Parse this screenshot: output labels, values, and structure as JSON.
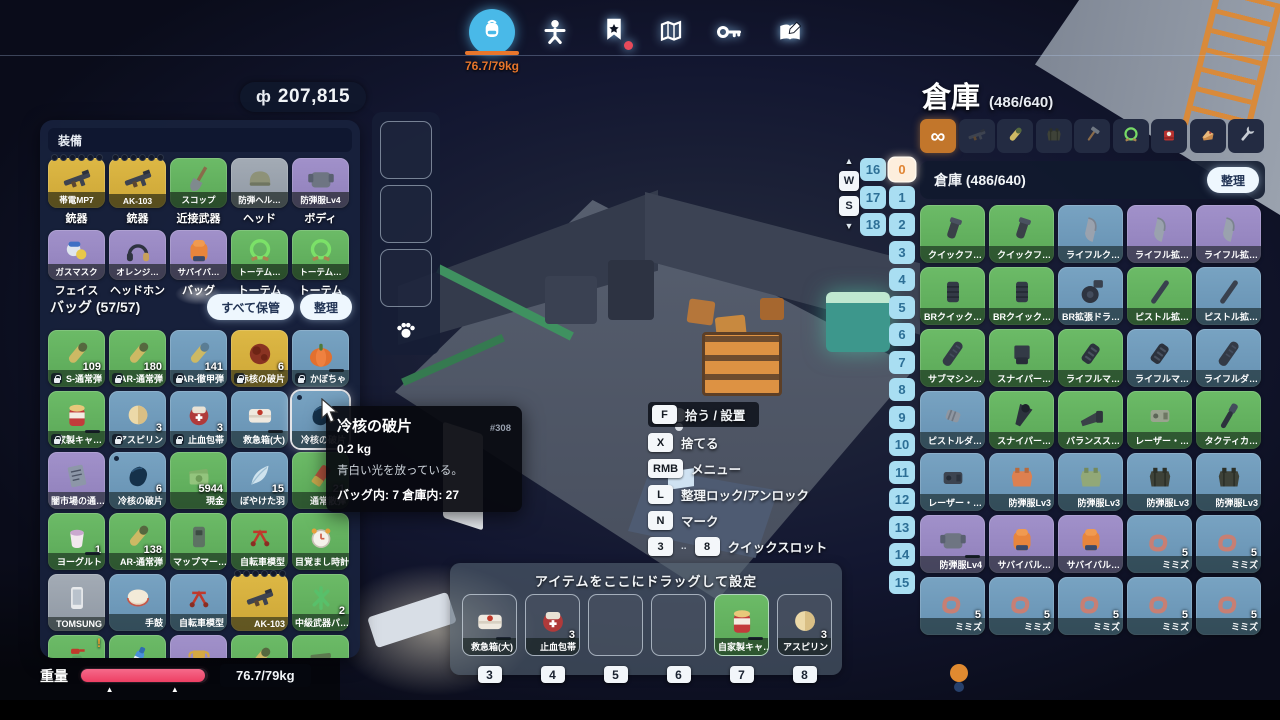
{
  "top": {
    "weight": "76.7/79kg",
    "icons": [
      "backpack-icon",
      "character-icon",
      "quest-icon",
      "map-icon",
      "key-icon",
      "journal-icon"
    ]
  },
  "money": {
    "symbol": "ф",
    "amount": "207,815"
  },
  "equipment": {
    "title": "装備",
    "items": [
      {
        "tag": "帯電MP7",
        "slot": "銃器",
        "color": "yellow",
        "icon": "gun",
        "dots": 6
      },
      {
        "tag": "AK-103",
        "slot": "銃器",
        "color": "yellow",
        "icon": "gun",
        "dots": 6
      },
      {
        "tag": "スコップ",
        "slot": "近接武器",
        "color": "green",
        "icon": "shovel"
      },
      {
        "tag": "防弾ヘル…",
        "slot": "ヘッド",
        "color": "gray",
        "icon": "helmet"
      },
      {
        "tag": "防弾服Lv4",
        "slot": "ボディ",
        "color": "purple",
        "icon": "armor"
      },
      {
        "tag": "ガスマスク",
        "slot": "フェイス",
        "color": "purple",
        "icon": "mask"
      },
      {
        "tag": "オレンジ…",
        "slot": "ヘッドホン",
        "color": "purple",
        "icon": "headphones"
      },
      {
        "tag": "サバイバ…",
        "slot": "バッグ",
        "color": "purple",
        "icon": "backpack",
        "glow": true
      },
      {
        "tag": "トーテム…",
        "slot": "トーテム",
        "color": "green",
        "icon": "ring"
      },
      {
        "tag": "トーテム…",
        "slot": "トーテム",
        "color": "green",
        "icon": "ring"
      }
    ]
  },
  "bag": {
    "title": "バッグ (57/57)",
    "store_all": "すべて保管",
    "sort": "整理",
    "items": [
      {
        "label": "S-通常弾",
        "count": "109",
        "color": "green",
        "icon": "bullet",
        "locked": true
      },
      {
        "label": "AR-通常弾",
        "count": "180",
        "color": "green",
        "icon": "bullet",
        "locked": true
      },
      {
        "label": "AR-徹甲弾",
        "count": "141",
        "color": "blue",
        "icon": "bullet2",
        "locked": true
      },
      {
        "label": "赤核の破片",
        "count": "6",
        "color": "yellow",
        "icon": "redcore",
        "locked": true
      },
      {
        "label": "かぼちゃ",
        "color": "blue",
        "icon": "pumpkin",
        "locked": true,
        "bar": true
      },
      {
        "label": "家製キャ…",
        "color": "green",
        "icon": "jar",
        "locked": true,
        "bar": true
      },
      {
        "label": "アスピリン",
        "count": "3",
        "color": "blue",
        "icon": "pill",
        "locked": true
      },
      {
        "label": "止血包帯",
        "count": "3",
        "color": "blue",
        "icon": "bandage",
        "locked": true
      },
      {
        "label": "救急箱(大)",
        "color": "blue",
        "icon": "medkit",
        "bar": true
      },
      {
        "label": "冷核の破片",
        "color": "blue",
        "icon": "shard",
        "marked": true,
        "hover": true
      },
      {
        "label": "闇市場の通…",
        "color": "purple",
        "icon": "note"
      },
      {
        "label": "冷核の破片",
        "count": "6",
        "color": "blue",
        "icon": "shard",
        "marked": true
      },
      {
        "label": "現金",
        "count": "5944",
        "color": "green",
        "icon": "money"
      },
      {
        "label": "ぼやけた羽",
        "count": "15",
        "color": "blue",
        "icon": "feather"
      },
      {
        "label": "通常散弾",
        "count": "21",
        "color": "green",
        "icon": "shell"
      },
      {
        "label": "ヨーグルト",
        "count": "1",
        "color": "green",
        "icon": "yogurt",
        "bar": true
      },
      {
        "label": "AR-通常弾",
        "count": "138",
        "color": "green",
        "icon": "bullet"
      },
      {
        "label": "マップマー…",
        "color": "green",
        "icon": "device"
      },
      {
        "label": "自転車模型",
        "color": "green",
        "icon": "bicycle"
      },
      {
        "label": "目覚まし時計",
        "color": "green",
        "icon": "clock"
      },
      {
        "label": "TOMSUNG",
        "color": "gray",
        "icon": "phone"
      },
      {
        "label": "手鼓",
        "color": "blue",
        "icon": "drum"
      },
      {
        "label": "自転車模型",
        "color": "blue",
        "icon": "bicycle"
      },
      {
        "label": "AK-103",
        "color": "yellow",
        "icon": "gun",
        "dots": 6
      },
      {
        "label": "中級武器パ…",
        "count": "2",
        "color": "green",
        "icon": "parts"
      },
      {
        "color": "green",
        "icon": "spray",
        "alert": "!"
      },
      {
        "color": "green",
        "icon": "bottle"
      },
      {
        "color": "purple",
        "icon": "trophy"
      },
      {
        "color": "green",
        "icon": "bullet"
      },
      {
        "color": "green",
        "icon": "folded"
      }
    ]
  },
  "pet": {
    "slots": 3,
    "icon": "paw"
  },
  "weight_bar": {
    "label": "重量",
    "value": "76.7/79kg",
    "fill_pct": 97,
    "color": "#ee3f63"
  },
  "tooltip": {
    "title": "冷核の破片",
    "id": "#308",
    "weight": "0.2 kg",
    "desc": "青白い光を放っている。",
    "counts": "バッグ内: 7 倉庫内: 27"
  },
  "context_menu": {
    "rows": [
      {
        "key": "F",
        "label": "拾う / 設置",
        "highlight": true
      },
      {
        "key": "X",
        "label": "捨てる"
      },
      {
        "key": "RMB",
        "label": "メニュー"
      },
      {
        "key": "L",
        "label": "整理ロック/アンロック"
      },
      {
        "key": "N",
        "label": "マーク"
      },
      {
        "key": "3",
        "key2": "8",
        "label": "クイックスロット"
      }
    ]
  },
  "warehouse": {
    "title": "倉庫",
    "capacity": "(486/640)",
    "subtitle": "倉庫 (486/640)",
    "sort": "整理",
    "nav_keys": {
      "up": "▲",
      "w": "W",
      "s": "S",
      "down": "▼"
    },
    "pages_left": [
      "16",
      "17",
      "18"
    ],
    "pages_right": [
      "0",
      "1",
      "2",
      "3",
      "4",
      "5",
      "6",
      "7",
      "8",
      "9",
      "10",
      "11",
      "12",
      "13",
      "14",
      "15"
    ],
    "selected_page": "0",
    "filter_tabs": [
      {
        "name": "all-filter",
        "icon": "infinity",
        "selected": true
      },
      {
        "name": "weapon-filter",
        "icon": "gun"
      },
      {
        "name": "ammo-filter",
        "icon": "bullet"
      },
      {
        "name": "armor-filter",
        "icon": "vest_black"
      },
      {
        "name": "tool-filter",
        "icon": "hammer"
      },
      {
        "name": "accessory-filter",
        "icon": "ring"
      },
      {
        "name": "medical-filter",
        "icon": "redbox"
      },
      {
        "name": "food-filter",
        "icon": "cake"
      },
      {
        "name": "parts-filter",
        "icon": "wrench"
      }
    ],
    "items": [
      {
        "label": "クイックフ…",
        "color": "green",
        "icon": "grip"
      },
      {
        "label": "クイックフ…",
        "color": "green",
        "icon": "grip"
      },
      {
        "label": "ライフルク…",
        "color": "blue",
        "icon": "magazine"
      },
      {
        "label": "ライフル拡…",
        "color": "purple",
        "icon": "magazine"
      },
      {
        "label": "ライフル拡…",
        "color": "purple",
        "icon": "magazine"
      },
      {
        "label": "BRクイック…",
        "color": "green",
        "icon": "grip2"
      },
      {
        "label": "BRクイック…",
        "color": "green",
        "icon": "grip2"
      },
      {
        "label": "BR拡張ドラ…",
        "color": "blue",
        "icon": "drummag"
      },
      {
        "label": "ピストル拡…",
        "color": "green",
        "icon": "tube"
      },
      {
        "label": "ピストル拡…",
        "color": "blue",
        "icon": "tube"
      },
      {
        "label": "サブマシン…",
        "color": "green",
        "icon": "suppressor"
      },
      {
        "label": "スナイパー…",
        "color": "green",
        "icon": "magblock"
      },
      {
        "label": "ライフルマ…",
        "color": "green",
        "icon": "muzzle"
      },
      {
        "label": "ライフルマ…",
        "color": "blue",
        "icon": "muzzle"
      },
      {
        "label": "ライフルダ…",
        "color": "blue",
        "icon": "suppressor"
      },
      {
        "label": "ピストルダ…",
        "color": "blue",
        "icon": "smallpart"
      },
      {
        "label": "スナイパー…",
        "color": "green",
        "icon": "scope"
      },
      {
        "label": "バランスス…",
        "color": "green",
        "icon": "stock"
      },
      {
        "label": "レーザー・…",
        "color": "green",
        "icon": "laser"
      },
      {
        "label": "タクティカ…",
        "color": "green",
        "icon": "flashlight"
      },
      {
        "label": "レーザー・…",
        "color": "blue",
        "icon": "laser2"
      },
      {
        "label": "防弾服Lv3",
        "color": "blue",
        "icon": "vest_orange"
      },
      {
        "label": "防弾服Lv3",
        "color": "blue",
        "icon": "vest_green"
      },
      {
        "label": "防弾服Lv3",
        "color": "blue",
        "icon": "vest_black"
      },
      {
        "label": "防弾服Lv3",
        "color": "blue",
        "icon": "vest_black"
      },
      {
        "label": "防弾服Lv4",
        "color": "purple",
        "icon": "armor",
        "bar": true
      },
      {
        "label": "サバイバル…",
        "color": "purple",
        "icon": "backpack"
      },
      {
        "label": "サバイバル…",
        "color": "purple",
        "icon": "backpack"
      },
      {
        "label": "ミミズ",
        "count": "5",
        "color": "blue",
        "icon": "worm"
      },
      {
        "label": "ミミズ",
        "count": "5",
        "color": "blue",
        "icon": "worm"
      },
      {
        "label": "ミミズ",
        "count": "5",
        "color": "blue",
        "icon": "worm"
      },
      {
        "label": "ミミズ",
        "count": "5",
        "color": "blue",
        "icon": "worm"
      },
      {
        "label": "ミミズ",
        "count": "5",
        "color": "blue",
        "icon": "worm"
      },
      {
        "label": "ミミズ",
        "count": "5",
        "color": "blue",
        "icon": "worm"
      },
      {
        "label": "ミミズ",
        "count": "5",
        "color": "blue",
        "icon": "worm"
      }
    ]
  },
  "quickbar": {
    "hint": "アイテムをここにドラッグして設定",
    "slots": [
      {
        "num": "3",
        "label": "救急箱(大)",
        "icon": "medkit",
        "bar": true
      },
      {
        "num": "4",
        "label": "止血包帯",
        "count": "3",
        "icon": "bandage"
      },
      {
        "num": "5"
      },
      {
        "num": "6"
      },
      {
        "num": "7",
        "label": "自家製キャ…",
        "icon": "jar",
        "color": "green",
        "bar": true
      },
      {
        "num": "8",
        "label": "アスピリン",
        "count": "3",
        "icon": "pill"
      }
    ]
  }
}
